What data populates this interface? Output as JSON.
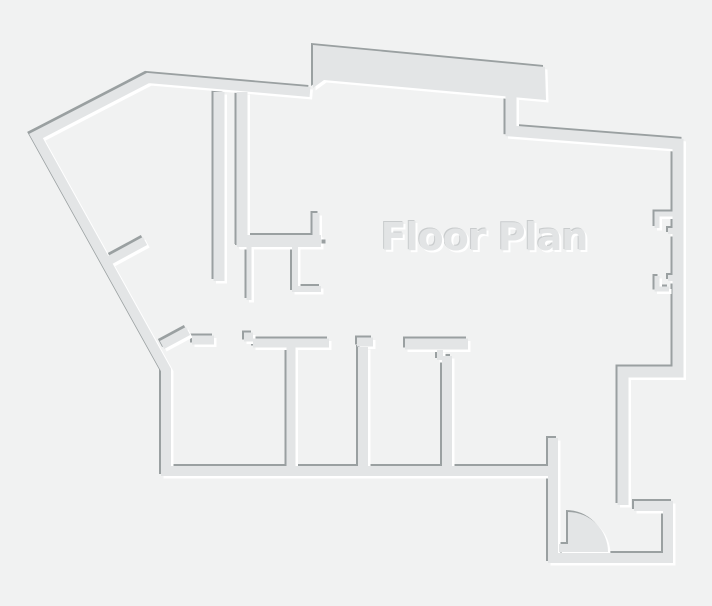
{
  "label": {
    "text": "Floor Plan",
    "x": 484,
    "y": 215,
    "font_size": 38
  },
  "colors": {
    "background": "#f1f2f2",
    "wall_fill": "#e3e5e6",
    "shadow_edge": "#9aa0a1",
    "highlight": "#ffffff",
    "title_color": "#e2e4e5",
    "title_shadow_light": "#ffffff",
    "title_shadow_dark": "#c9cccd"
  },
  "canvas": {
    "width": 712,
    "height": 606
  },
  "floor_plan": {
    "emboss": {
      "dark_offset": -2,
      "light_offset": 2.5
    },
    "shapes": [
      {
        "name": "top-band-wall",
        "d": "M313,45 L545,67 L546,100 L324,80 L313,88 Z"
      },
      {
        "name": "door-swing",
        "d": "M568,552 L568,512 A40 40 0 0 1 608,552 Z"
      }
    ],
    "walls": [
      {
        "name": "outer-wall-west-south",
        "d": "M553,471 L166,471 L166,370 L36,136 L148,78 L310,92",
        "w": 10
      },
      {
        "name": "outer-wall-east",
        "d": "M511,95 L511,131 L678,144 L678,372 L623,372 L623,505",
        "w": 11
      },
      {
        "name": "entry-perimeter-wall",
        "d": "M634,506 L668,506 L668,558 L553,558 L553,438",
        "w": 10
      },
      {
        "name": "core-wall-west",
        "d": "M219,92 L219,281",
        "w": 11
      },
      {
        "name": "core-wall-east",
        "d": "M242,92 L242,246",
        "w": 11
      },
      {
        "name": "closet-wall-south",
        "d": "M237,241 L321,241",
        "w": 12
      },
      {
        "name": "closet-return-north",
        "d": "M316,241 L316,213",
        "w": 7
      },
      {
        "name": "closet-stub",
        "d": "M249,247 L249,300",
        "w": 5
      },
      {
        "name": "closet-hook-wall",
        "d": "M295,247 L295,289 L321,289",
        "w": 6
      },
      {
        "name": "rooms-top-wall-segment-1",
        "d": "M192,340 L214,340",
        "w": 9
      },
      {
        "name": "rooms-top-wall-jog",
        "d": "M244,337 L253,337",
        "w": 9
      },
      {
        "name": "rooms-top-wall-segment-2",
        "d": "M253,343 L329,343",
        "w": 9
      },
      {
        "name": "room-divider-1",
        "d": "M291,343 L291,471",
        "w": 9
      },
      {
        "name": "rooms-top-wall-cap-2",
        "d": "M357,342 L373,342",
        "w": 9
      },
      {
        "name": "room-divider-2",
        "d": "M363,347 L363,471",
        "w": 10
      },
      {
        "name": "rooms-top-wall-tbar",
        "d": "M405,344 L468,344",
        "w": 11
      },
      {
        "name": "tbar-door-stub",
        "d": "M440,350 L440,360",
        "w": 6
      },
      {
        "name": "room-divider-3",
        "d": "M447,356 L447,471",
        "w": 10
      },
      {
        "name": "window-notch-1",
        "d": "M674,214 L657,214 L657,228",
        "w": 5
      },
      {
        "name": "window-bump-1",
        "d": "M668,231 L674,231",
        "w": 6
      },
      {
        "name": "window-bump-2",
        "d": "M668,278 L674,278",
        "w": 6
      },
      {
        "name": "window-notch-2",
        "d": "M657,276 L657,289 L669,289",
        "w": 5
      },
      {
        "name": "angled-door-stub-1",
        "d": "M110,260 L145,241",
        "w": 9
      },
      {
        "name": "angled-door-stub-2",
        "d": "M162,345 L188,331",
        "w": 9
      },
      {
        "name": "door-jamb",
        "d": "M559,548 L571,548",
        "w": 8
      }
    ],
    "marks": [
      {
        "name": "wall-dot",
        "x": 321.5,
        "y": 239.5,
        "w": 4,
        "h": 4
      }
    ]
  }
}
